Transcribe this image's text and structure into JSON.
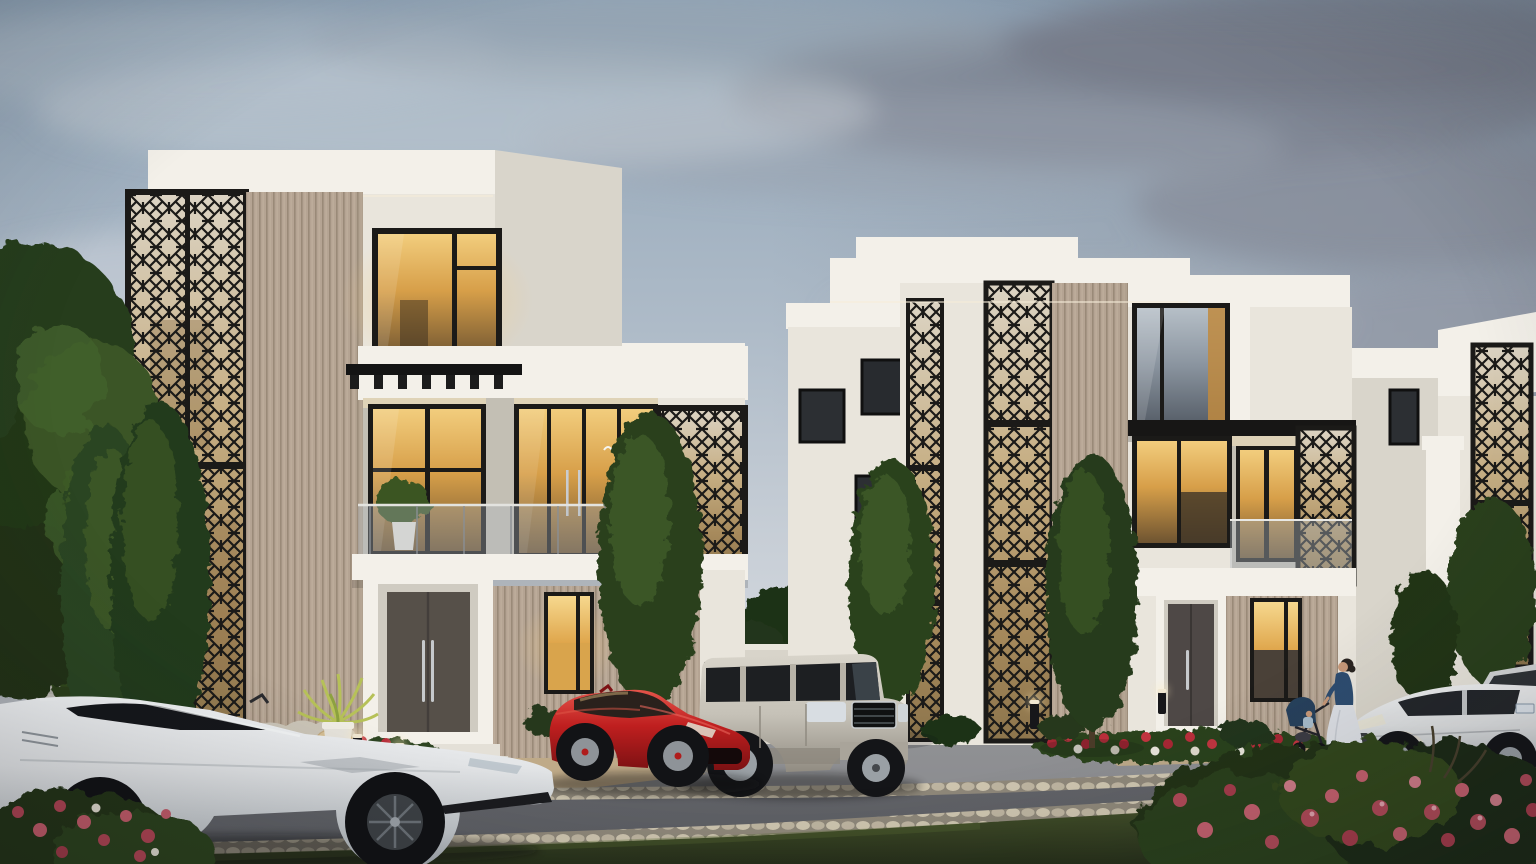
{
  "scene": {
    "kind": "architectural exterior render",
    "lighting": "dusk with lit interiors",
    "objects": {
      "buildings": [
        "villa-left",
        "villa-right",
        "villa-far-right",
        "compound-walls"
      ],
      "building_features": [
        "mashrabiya-lattice-screens",
        "ribbed-stone-panels",
        "glass-balustrade-balconies",
        "black-pergola",
        "entry-doors-with-steps",
        "lit-windows"
      ],
      "vehicles": [
        "lamborghini-white",
        "ferrari-red",
        "range-rover-champagne",
        "sedan-white",
        "sedan-white-rear"
      ],
      "people": [
        "person-on-balcony",
        "woman-with-stroller",
        "baby-in-stroller"
      ],
      "vegetation": [
        "canopy-tree",
        "cypress-trees",
        "hedges",
        "palm-planter",
        "balcony-plant",
        "flower-bed-left",
        "flower-bed-right",
        "rose-bush-foreground",
        "corner-flower-bush",
        "lawn"
      ],
      "street": [
        "driveway-pavement",
        "cobblestone-curbs",
        "asphalt-road",
        "tan-walkways",
        "boulders",
        "bollard-lights"
      ]
    }
  },
  "colors": {
    "sky_top": "#8fa3b6",
    "sky_mid": "#c7ced6",
    "sky_low": "#dcdfe4",
    "cloud_dark": "#787e8b",
    "cloud_mid": "#9aa2ae",
    "cloud_light": "#ccd3da",
    "stone_bright": "#f3f0e9",
    "stone_lit": "#e9e5dc",
    "stone_side": "#d9d5cb",
    "stone_shadow": "#c3bfb4",
    "rib_base": "#b5a493",
    "rib_line": "#9a8a78",
    "lattice_black": "#1b1a18",
    "lattice_tan": "#c6ae83",
    "glass_warm_hi": "#f2cd7d",
    "glass_warm_mid": "#d79f49",
    "glass_warm_dark": "#6e5431",
    "glass_cool_hi": "#b6bfc7",
    "glass_cool_dark": "#5a626c",
    "door_brown": "#565049",
    "pave": "#86878b",
    "asphalt": "#64656a",
    "cobble": "#b4ab97",
    "walk_tan": "#c8af86",
    "grass_dark": "#27301a",
    "grass_mid": "#4c5a2f",
    "leaf_dark": "#243419",
    "leaf_mid": "#33491f",
    "leaf_light": "#4a6628",
    "rose_red": "#a82734",
    "rose_pink": "#c4606e",
    "rose_white": "#e7e4da",
    "ferrari_red": "#bf1f1f",
    "lambo_white": "#e3e5e7",
    "rover_champagne": "#c6c2b8",
    "sedan_white": "#dfe1e2",
    "skin": "#c79878",
    "navy": "#2e4d70",
    "skirt": "#dde0e5",
    "rock_light": "#cbc5b8",
    "rock_tan": "#c2a87c"
  }
}
